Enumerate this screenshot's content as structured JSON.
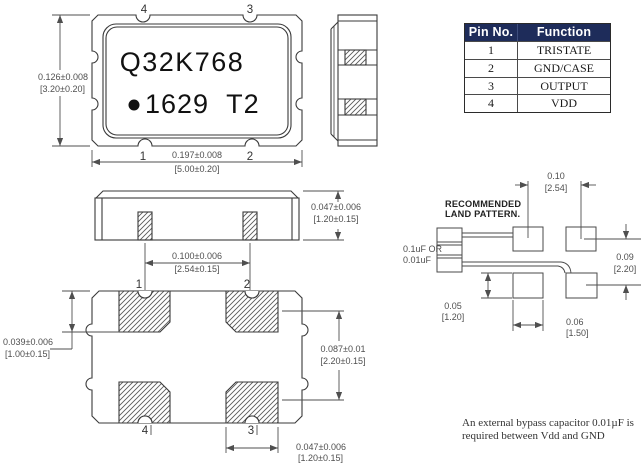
{
  "top_view": {
    "pin_top_left": "4",
    "pin_top_right": "3",
    "pin_bottom_left": "1",
    "pin_bottom_right": "2",
    "marking_line1": "Q32K768",
    "marking_line2": "1629 T2",
    "height_dim": "0.126±0.008",
    "height_dim_mm": "[3.20±0.20]",
    "width_dim": "0.197±0.008",
    "width_dim_mm": "[5.00±0.20]"
  },
  "pin_table": {
    "headers": [
      "Pin No.",
      "Function"
    ],
    "rows": [
      {
        "pin": "1",
        "function": "TRISTATE"
      },
      {
        "pin": "2",
        "function": "GND/CASE"
      },
      {
        "pin": "3",
        "function": "OUTPUT"
      },
      {
        "pin": "4",
        "function": "VDD"
      }
    ]
  },
  "side_view": {
    "height_dim": "0.047±0.006",
    "height_dim_mm": "[1.20±0.15]",
    "pad_pitch_dim": "0.100±0.006",
    "pad_pitch_dim_mm": "[2.54±0.15]"
  },
  "bottom_view": {
    "pin_top_left": "1",
    "pin_top_right": "2",
    "pin_bottom_left": "4",
    "pin_bottom_right": "3",
    "pad_length_dim": "0.039±0.006",
    "pad_length_dim_mm": "[1.00±0.15]",
    "row_pitch_dim": "0.087±0.01",
    "row_pitch_dim_mm": "[2.20±0.15]",
    "pad_width_dim": "0.047±0.006",
    "pad_width_dim_mm": "[1.20±0.15]"
  },
  "land_pattern": {
    "title_line1": "RECOMMENDED",
    "title_line2": "LAND PATTERN.",
    "cap_label_line1": "0.1uF OR",
    "cap_label_line2": "0.01uF",
    "pitch_x": "0.10",
    "pitch_x_mm": "[2.54]",
    "pitch_y": "0.09",
    "pitch_y_mm": "[2.20]",
    "pad_height": "0.05",
    "pad_height_mm": "[1.20]",
    "pad_width": "0.06",
    "pad_width_mm": "[1.50]"
  },
  "note": {
    "line1": "An external bypass capacitor 0.01µF is",
    "line2": "required between Vdd and GND"
  },
  "colors": {
    "table_header_bg": "#1e2c5a",
    "table_header_fg": "#ffffff",
    "line": "#3a3a3a",
    "dim": "#4f4f4f"
  }
}
